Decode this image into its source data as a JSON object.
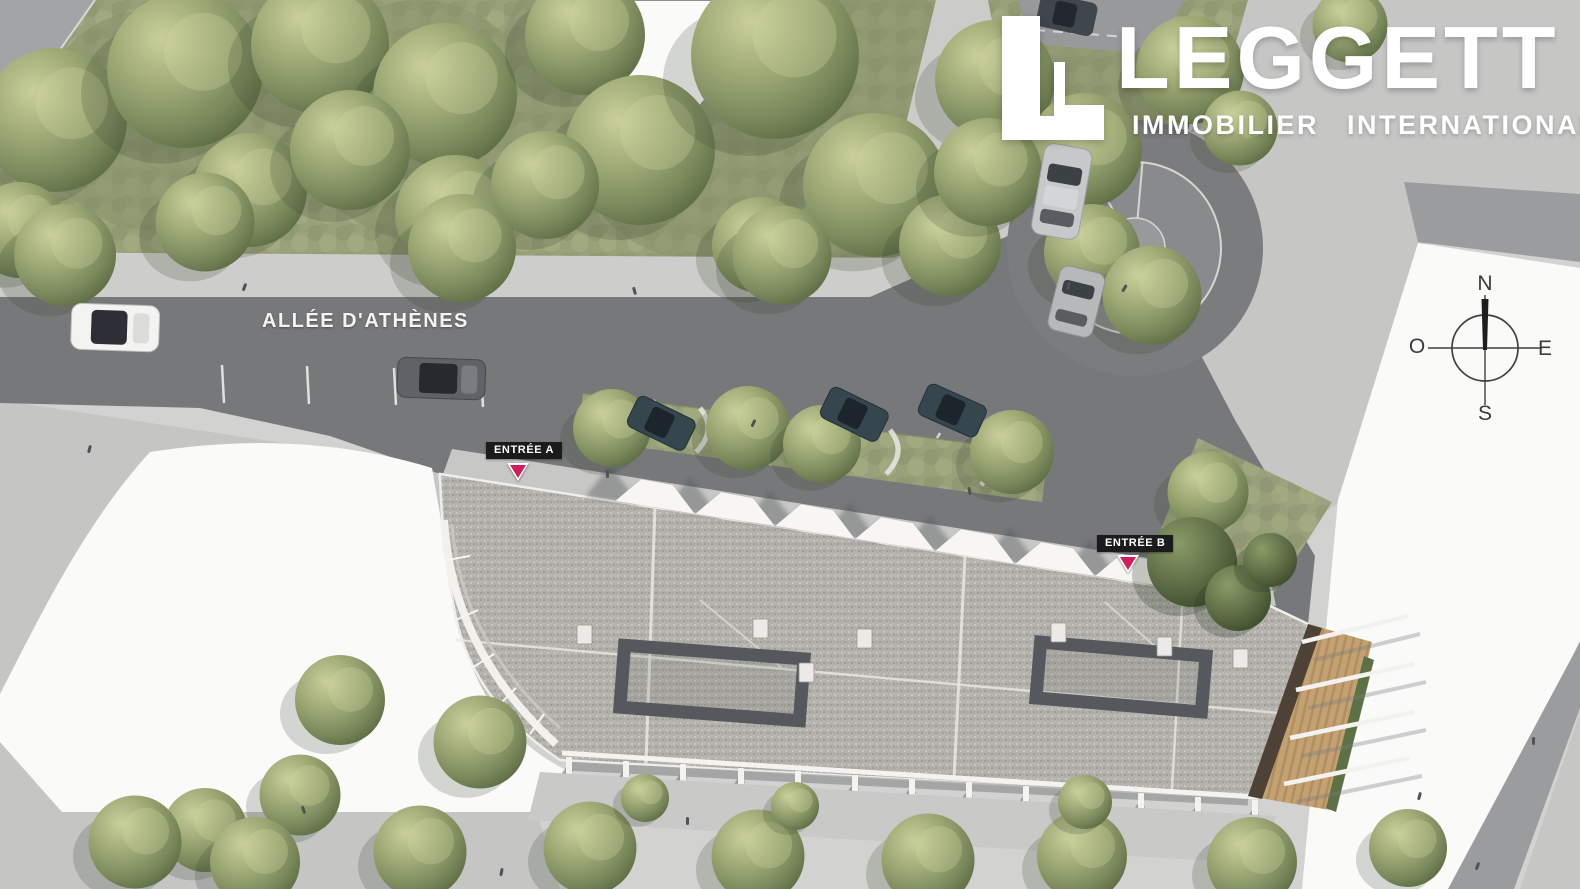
{
  "branding": {
    "logo_text": "LEGGETT",
    "logo_subtitle": "IMMOBILIER INTERNATIONAL"
  },
  "street": {
    "label": "ALLÉE D'ATHÈNES"
  },
  "entrances": {
    "a": "ENTRÉE A",
    "b": "ENTRÉE B"
  },
  "compass": {
    "north": "N",
    "east": "E",
    "south": "S",
    "west": "O"
  },
  "palette": {
    "marker-pink": "#cf1d5e",
    "badge-black": "#1b1b1b",
    "logo-white": "#ffffff",
    "compass-ink": "#3b3b3b",
    "street-label-white": "#f4f4f2",
    "road-gray": "#77787a",
    "sidewalk-gray": "#cdcdcb",
    "plaza-gray": "#c6c6c4",
    "grass-green": "#99a17b",
    "roof-gravel": "#b3b1ab",
    "white-parcel": "#fafaf9",
    "deck-wood": "#c3a173"
  }
}
